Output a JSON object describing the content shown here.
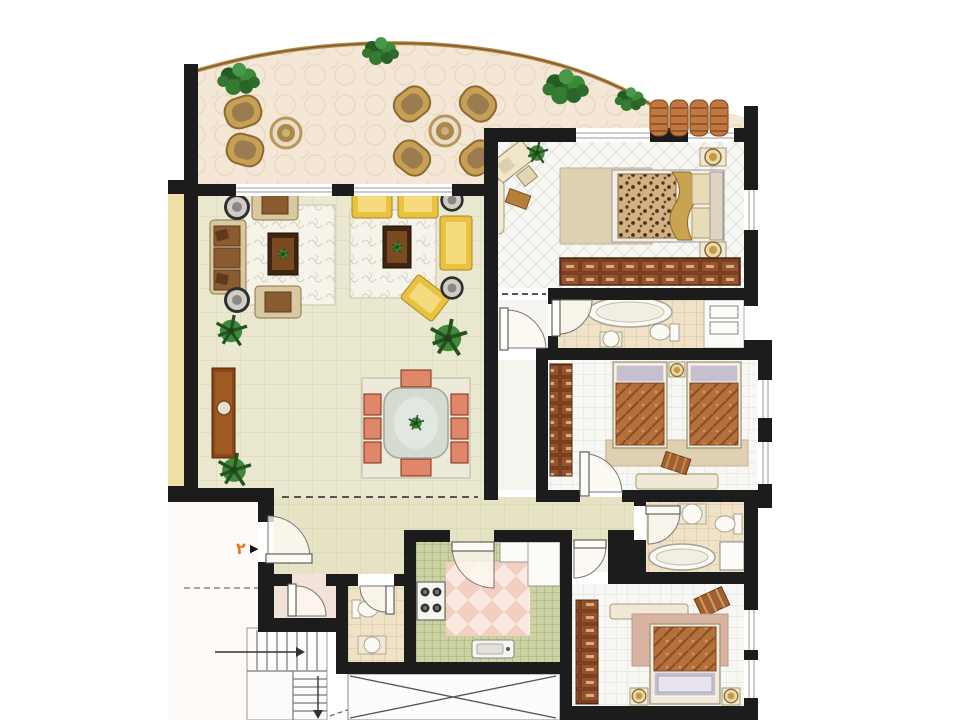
{
  "labels": {
    "unit_number": "٢"
  },
  "icons": {
    "entrance_pointer": "▶"
  },
  "colors": {
    "page": "#ffffff",
    "wall": "#1c1c1c",
    "terrace": "#f4e7d6",
    "railing": "#b58a4e",
    "living": "#ebe8d0",
    "corridor": "#e6e3c5",
    "bedroomFloor": "#f7f7f3",
    "bathTile": "#efe2c6",
    "kitchenCounter": "#ccd2a2",
    "kitchenFloor": "#fbeae2",
    "outside": "#fdfaf8",
    "sideStrip": "#f0dfa5",
    "sofaYellow": "#e9c33f",
    "sofaBrown": "#8a5a30",
    "sofaTan": "#d9c9a0",
    "chairSalmon": "#e0876a",
    "wood": "#8a4518",
    "woodDark": "#3f2410",
    "rugWhite": "#f6f4ea",
    "rugBeige": "#dfd0b4",
    "rugPink": "#d9b3a2",
    "plant": "#3a7a35",
    "awning": "#c07840",
    "accent": "#e07830",
    "bedRust": "#b5713c",
    "leopard": "#d2b184",
    "marble": "#d4dcd2",
    "pillowGray": "#c5bfce"
  }
}
